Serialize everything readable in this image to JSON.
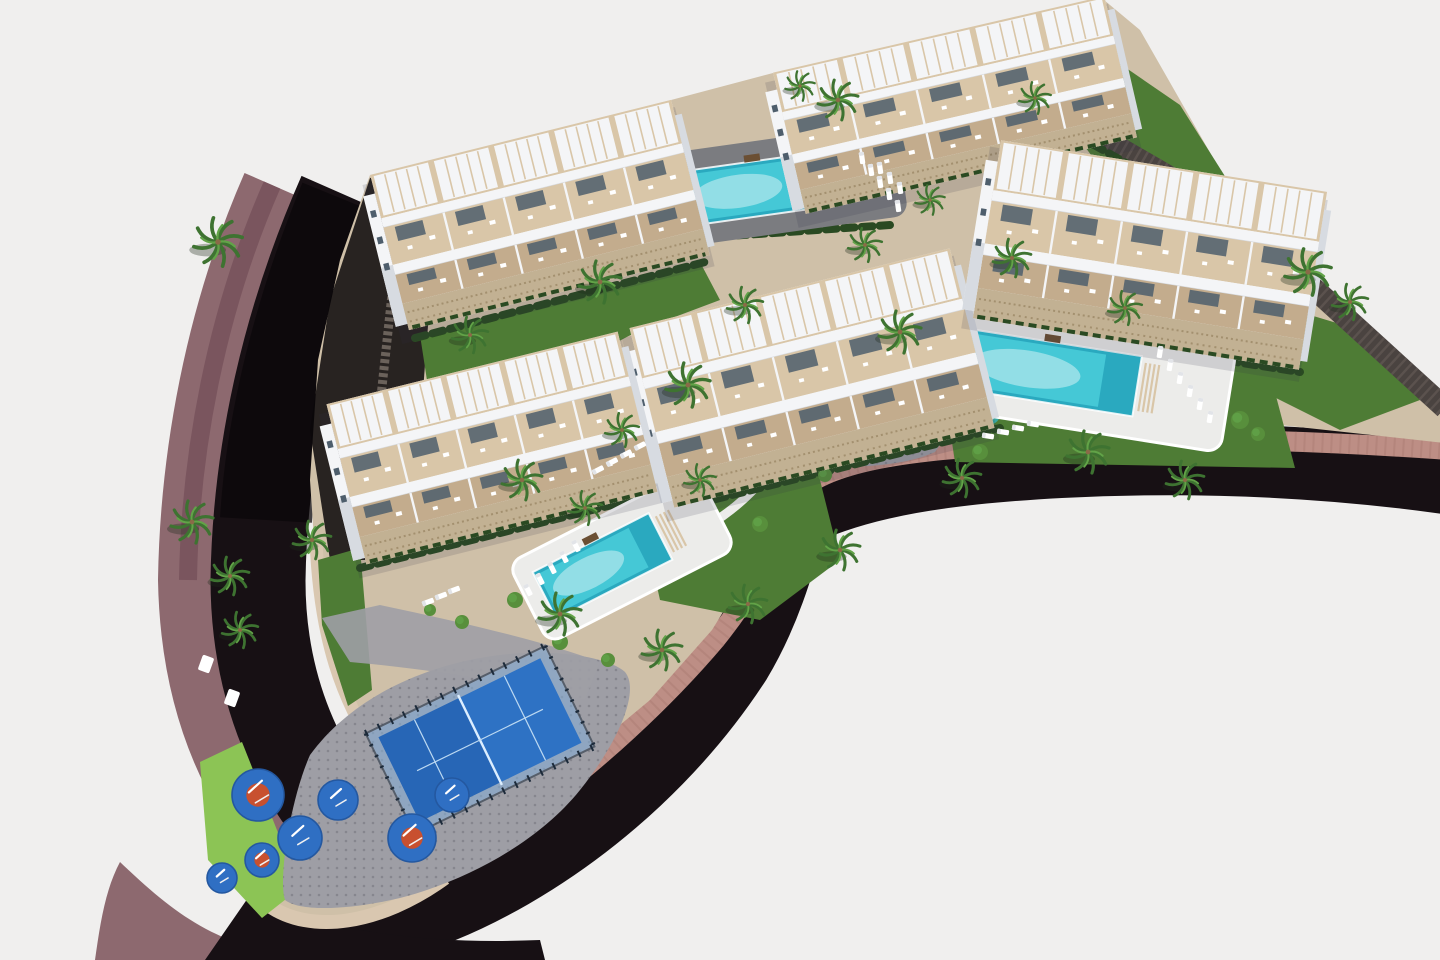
{
  "meta": {
    "title": "Aerial 3D architectural render of a coastal residential complex",
    "description": "Bird's-eye rendering: five white apartment blocks with tiered cream terraces and pergolas, three turquoise swimming pools, palm-lined gardens, a blue padel court, an outdoor-gym playground with blue pads, all wrapped by a dark asphalt road with a mauve sidewalk."
  },
  "palette": {
    "bg": "#f0efee",
    "road": "#171014",
    "roadDeep": "#0b0709",
    "mauve": "#8d696f",
    "mauveDark": "#7a555e",
    "wallPink": "#bd8e85",
    "wallBrick": "#a87a72",
    "curb": "#d9c7b0",
    "plate": "#cfc0a8",
    "plateLight": "#dccfb9",
    "paving": "#9e9ea5",
    "pavingDot": "#73737c",
    "deckGray": "#7b7c80",
    "deckLight": "#ececea",
    "lawn": "#4e7c35",
    "lawnBright": "#8cc455",
    "lawnPale": "#a9cf6a",
    "hedge": "#2a4a22",
    "shrub": "#588f3c",
    "palm": "#3e7331",
    "palmLight": "#62a348",
    "trunk": "#8a6a48",
    "white": "#f4f5f7",
    "whiteShade": "#d7dbe1",
    "cream": "#d9c6a8",
    "creamDark": "#c3ac8d",
    "stoneBase": "#c2b193",
    "stoneSpeckle": "#a3906f",
    "glass": "#4e5e6c",
    "stoneWall": "#4a4340",
    "stoneWallLight": "#6b625b",
    "water": "#45c8d6",
    "waterLight": "#a5e4ea",
    "waterDeep": "#2aa9bf",
    "padelBlue": "#2e72c4",
    "padelDark": "#2059a8",
    "padelGlass": "#84aed8",
    "padelFrame": "#1c2a3a",
    "padBlue": "#2f6fc3",
    "padBlueEdge": "#2458a0",
    "padOrange": "#c8502f",
    "boulder": "#a8adb3",
    "slideRed": "#c8452f",
    "slideYellow": "#e0b23c",
    "splashTeal": "#3aa8a0"
  },
  "scene": {
    "counts": {
      "buildings": 5,
      "pools": 3,
      "padel_courts": 1,
      "playground_pads": 7,
      "palm_trees": 30
    },
    "buildings": [
      {
        "id": "building-top-left",
        "cx": 540,
        "cy": 215,
        "rot": -14,
        "len": 310,
        "dep": 160,
        "units": 5
      },
      {
        "id": "building-top-right",
        "cx": 955,
        "cy": 105,
        "rot": -13,
        "len": 340,
        "dep": 145,
        "units": 5
      },
      {
        "id": "building-center",
        "cx": 812,
        "cy": 378,
        "rot": -14,
        "len": 330,
        "dep": 185,
        "units": 5
      },
      {
        "id": "building-right",
        "cx": 1150,
        "cy": 255,
        "rot": 9,
        "len": 330,
        "dep": 180,
        "units": 5
      },
      {
        "id": "building-left",
        "cx": 492,
        "cy": 448,
        "rot": -14,
        "len": 300,
        "dep": 165,
        "units": 5
      }
    ],
    "pools": [
      {
        "id": "pool-north",
        "cx": 783,
        "cy": 185,
        "rot": -8,
        "len": 240,
        "dep": 95,
        "deck": "gray"
      },
      {
        "id": "pool-east",
        "cx": 1085,
        "cy": 378,
        "rot": 9,
        "len": 290,
        "dep": 105,
        "deck": "light"
      },
      {
        "id": "pool-south",
        "cx": 622,
        "cy": 556,
        "rot": -27,
        "len": 210,
        "dep": 90,
        "deck": "light"
      }
    ],
    "padel": {
      "cx": 480,
      "cy": 740,
      "rot": -26,
      "len": 200,
      "dep": 112
    },
    "playground_pads": [
      [
        258,
        795,
        26,
        1
      ],
      [
        300,
        838,
        22,
        0
      ],
      [
        338,
        800,
        20,
        0
      ],
      [
        262,
        860,
        17,
        1
      ],
      [
        412,
        838,
        24,
        1
      ],
      [
        452,
        795,
        17,
        0
      ],
      [
        222,
        878,
        15,
        0
      ]
    ],
    "palms": [
      [
        218,
        242,
        1.15
      ],
      [
        600,
        282,
        1.0
      ],
      [
        688,
        385,
        1.05
      ],
      [
        745,
        305,
        0.85
      ],
      [
        522,
        480,
        0.95
      ],
      [
        192,
        522,
        1.0
      ],
      [
        230,
        576,
        0.9
      ],
      [
        240,
        630,
        0.85
      ],
      [
        312,
        540,
        0.9
      ],
      [
        470,
        335,
        0.85
      ],
      [
        838,
        100,
        0.95
      ],
      [
        800,
        86,
        0.7
      ],
      [
        900,
        332,
        1.0
      ],
      [
        1012,
        258,
        0.9
      ],
      [
        1088,
        452,
        1.0
      ],
      [
        1185,
        480,
        0.9
      ],
      [
        1308,
        272,
        1.1
      ],
      [
        1350,
        302,
        0.85
      ],
      [
        962,
        478,
        0.9
      ],
      [
        622,
        430,
        0.8
      ],
      [
        840,
        550,
        0.95
      ],
      [
        748,
        604,
        0.9
      ],
      [
        560,
        614,
        1.0
      ],
      [
        662,
        650,
        0.95
      ],
      [
        1125,
        308,
        0.8
      ],
      [
        1035,
        98,
        0.75
      ],
      [
        585,
        508,
        0.8
      ],
      [
        700,
        480,
        0.75
      ],
      [
        865,
        245,
        0.8
      ],
      [
        930,
        200,
        0.7
      ]
    ],
    "shrubs": [
      [
        650,
        352,
        9
      ],
      [
        668,
        368,
        7
      ],
      [
        980,
        452,
        8
      ],
      [
        1240,
        420,
        9
      ],
      [
        1258,
        434,
        7
      ],
      [
        560,
        642,
        8
      ],
      [
        462,
        622,
        7
      ],
      [
        880,
        302,
        8
      ],
      [
        896,
        312,
        6
      ],
      [
        760,
        524,
        8
      ],
      [
        624,
        530,
        7
      ],
      [
        1060,
        300,
        7
      ],
      [
        1150,
        420,
        8
      ],
      [
        700,
        430,
        7
      ],
      [
        515,
        600,
        8
      ],
      [
        430,
        610,
        6
      ],
      [
        608,
        660,
        7
      ],
      [
        825,
        475,
        7
      ]
    ],
    "boulders": [
      [
        856,
        420,
        7
      ],
      [
        870,
        428,
        5
      ],
      [
        884,
        416,
        6
      ],
      [
        864,
        434,
        4
      ],
      [
        898,
        426,
        4
      ],
      [
        842,
        428,
        4
      ]
    ],
    "lounger_rows": [
      {
        "x": 862,
        "y": 158,
        "dx": 9,
        "dy": 12,
        "n": 5,
        "rot": 82
      },
      {
        "x": 880,
        "y": 168,
        "dx": 10,
        "dy": 10,
        "n": 3,
        "rot": 82
      },
      {
        "x": 1160,
        "y": 352,
        "dx": 10,
        "dy": 13,
        "n": 6,
        "rot": 99
      },
      {
        "x": 988,
        "y": 436,
        "dx": 15,
        "dy": -4,
        "n": 4,
        "rot": 9
      },
      {
        "x": 528,
        "y": 590,
        "dx": 12,
        "dy": -11,
        "n": 5,
        "rot": 63
      },
      {
        "x": 598,
        "y": 470,
        "dx": 14,
        "dy": -8,
        "n": 4,
        "rot": -27
      },
      {
        "x": 428,
        "y": 602,
        "dx": 13,
        "dy": -6,
        "n": 3,
        "rot": -20
      }
    ]
  }
}
